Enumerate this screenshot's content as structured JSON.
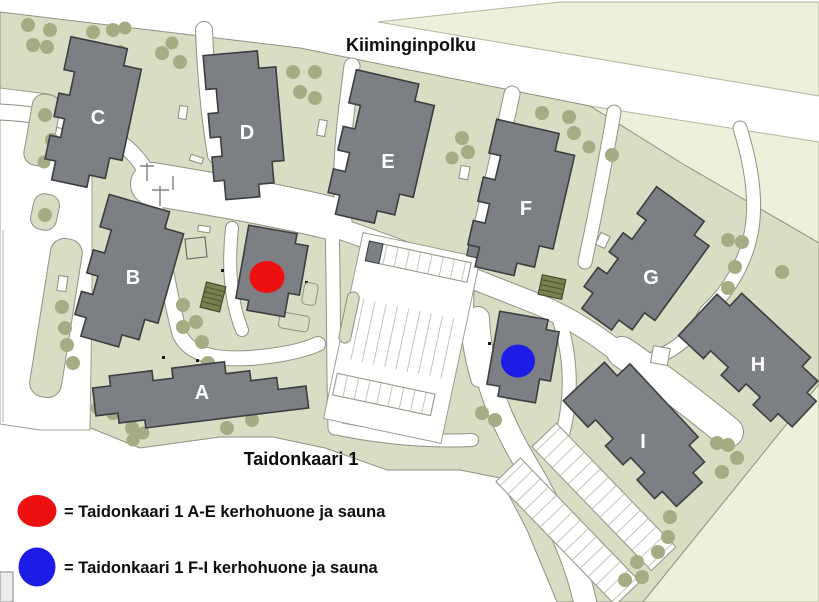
{
  "colors": {
    "red_marker": "#ee0f10",
    "blue_marker": "#1c1ce6",
    "building_gray": "#7c7f83",
    "grass_green": "#d9ddc4",
    "pale_green": "#eef0db",
    "tree_green": "#a5ac84",
    "road_white": "#ffffff"
  },
  "map": {
    "street_label": "Kiiminginpolku",
    "address_label": "Taidonkaari 1",
    "buildings": [
      {
        "label": "A"
      },
      {
        "label": "B"
      },
      {
        "label": "C"
      },
      {
        "label": "D"
      },
      {
        "label": "E"
      },
      {
        "label": "F"
      },
      {
        "label": "G"
      },
      {
        "label": "H"
      },
      {
        "label": "I"
      }
    ]
  },
  "legend": {
    "items": [
      {
        "color": "#ee0f10",
        "label": "= Taidonkaari 1 A-E kerhohuone ja sauna"
      },
      {
        "color": "#1c1ce6",
        "label": "= Taidonkaari 1 F-I kerhohuone ja sauna"
      }
    ]
  }
}
